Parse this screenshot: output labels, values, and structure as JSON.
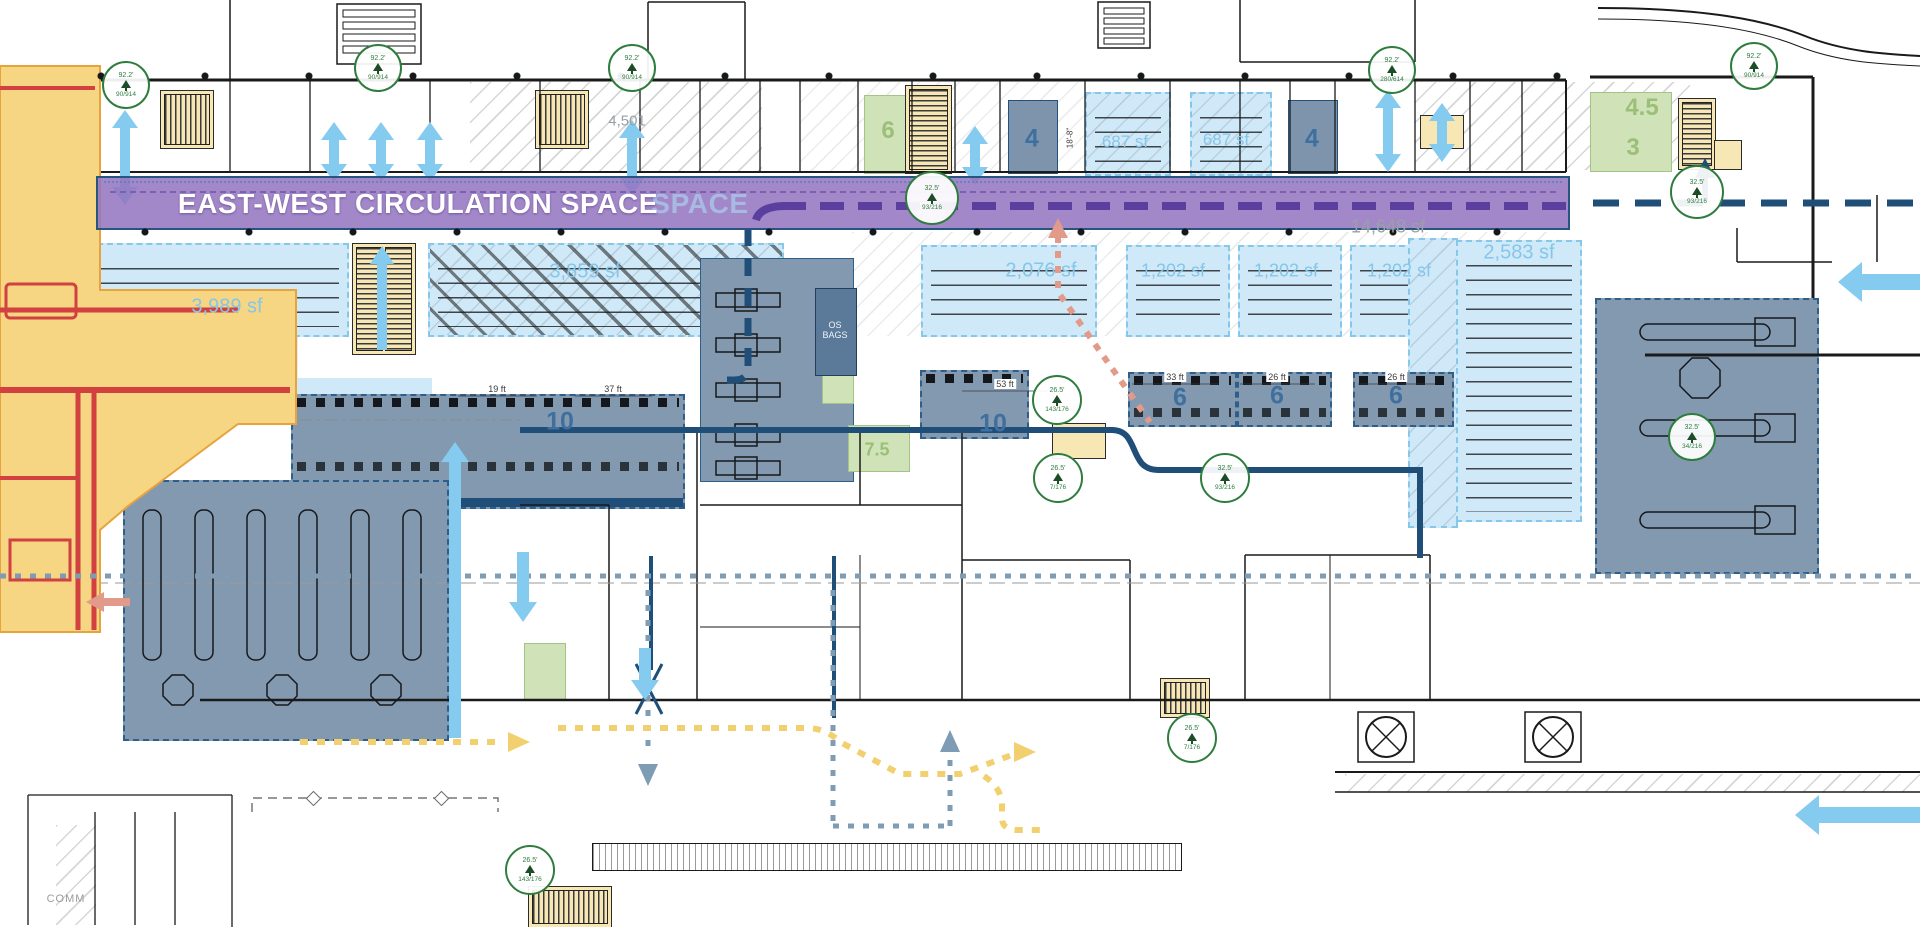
{
  "banner": {
    "label": "EAST-WEST CIRCULATION SPACE",
    "ghost_tail": "SPACE"
  },
  "area_labels": [
    {
      "id": "holdroom-west",
      "text": "3,989 sf"
    },
    {
      "id": "holdroom-west-2",
      "text": "3,859 sf"
    },
    {
      "id": "room-687-a",
      "text": "687 sf"
    },
    {
      "id": "room-687-b",
      "text": "687 sf"
    },
    {
      "id": "holdroom-mid",
      "text": "2,076 sf"
    },
    {
      "id": "holdroom-east-1",
      "text": "1,202 sf"
    },
    {
      "id": "holdroom-east-2",
      "text": "1,202 sf"
    },
    {
      "id": "holdroom-east-3",
      "text": "1,202 sf"
    },
    {
      "id": "holdroom-far-east",
      "text": "2,583 sf"
    },
    {
      "id": "circulation-area",
      "text": "14,648 sf"
    },
    {
      "id": "corridor-area",
      "text": "4,501"
    }
  ],
  "counts": [
    "10",
    "10",
    "6",
    "6",
    "6",
    "4",
    "4",
    "6",
    "7.5",
    "4.5",
    "3"
  ],
  "dimensions": [
    "19 ft",
    "37 ft",
    "53 ft",
    "33 ft",
    "26 ft",
    "26 ft",
    "18'-8\""
  ],
  "rooms": {
    "os_bags": "OS BAGS",
    "comm": "COMM"
  },
  "markers": [
    {
      "elev": "92.2'",
      "ref": "90/914"
    },
    {
      "elev": "92.2'",
      "ref": "90/914"
    },
    {
      "elev": "92.2'",
      "ref": "90/914"
    },
    {
      "elev": "32.5'",
      "ref": "93/216"
    },
    {
      "elev": "92.2'",
      "ref": "280/614"
    },
    {
      "elev": "92.2'",
      "ref": "90/914"
    },
    {
      "elev": "32.5'",
      "ref": "93/216"
    },
    {
      "elev": "26.5'",
      "ref": "143/176"
    },
    {
      "elev": "26.5'",
      "ref": "7/176"
    },
    {
      "elev": "32.5'",
      "ref": "93/216"
    },
    {
      "elev": "32.5'",
      "ref": "34/216"
    },
    {
      "elev": "26.5'",
      "ref": "7/176"
    },
    {
      "elev": "26.5'",
      "ref": "143/176"
    }
  ],
  "colors": {
    "circulation_band": "#9b7fc8",
    "hold_room_fill": "#cfe9f8",
    "secure_zone_fill": "#8399b0",
    "bhs_zone_fill": "#f6d583",
    "bhs_line": "#d24040",
    "vertical_circulation_arrow": "#85cbf0",
    "route_navy": "#1f4e79",
    "route_purple": "#5b3f9e",
    "route_yellow": "#f2cf6f",
    "route_salmon": "#e29a8a",
    "route_steel": "#7f9cb5",
    "marker_green": "#2e7d3e"
  }
}
